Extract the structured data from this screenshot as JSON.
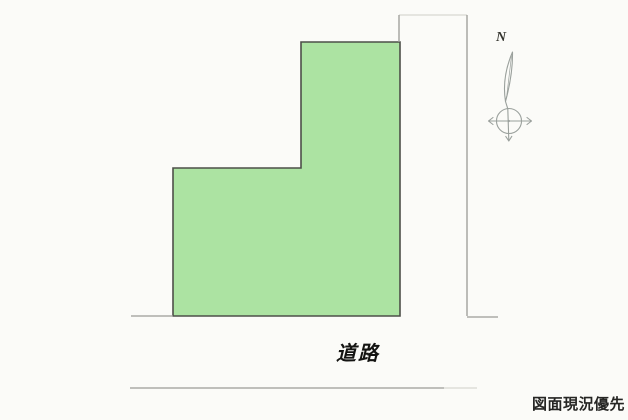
{
  "diagram": {
    "kind": "land-plot-site-plan-scan"
  },
  "compass": {
    "north_label": "N"
  },
  "roads": {
    "label": "道路"
  },
  "footer": {
    "caption": "図面現況優先"
  },
  "colors": {
    "paper": "#fbfbf8",
    "plot_fill": "#ace3a2",
    "plot_border": "#4d4f49",
    "road_line": "#9b9b96",
    "road_line_faint": "#d8d8d2",
    "compass_stroke": "#9aa09c",
    "north_text": "#35352f",
    "road_text": "#141412",
    "caption_text": "#262624"
  }
}
